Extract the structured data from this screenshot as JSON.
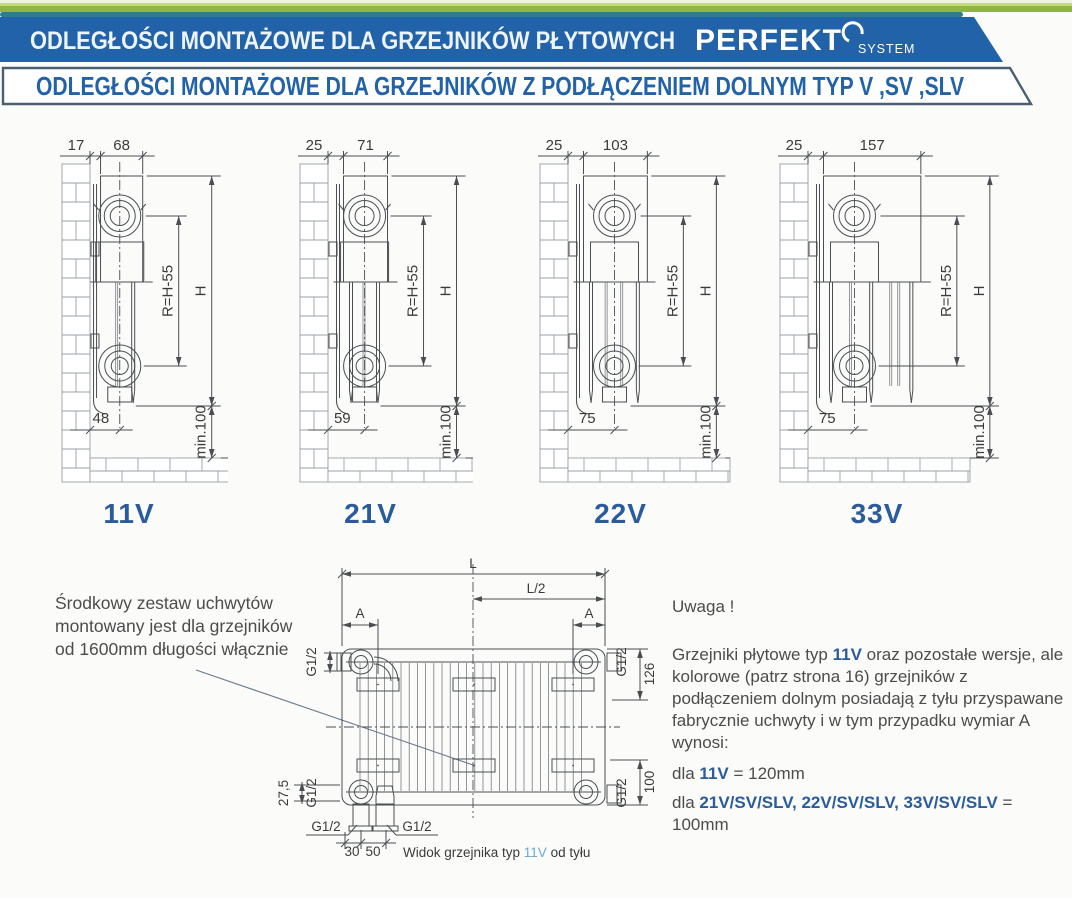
{
  "header": {
    "row1": "ODLEGŁOŚCI  MONTAŻOWE  DLA  GRZEJNIKÓW  PŁYTOWYCH",
    "brand": "PERFEKT",
    "brand_sub": "SYSTEM",
    "row2": "ODLEGŁOŚCI MONTAŻOWE DLA GRZEJNIKÓW Z PODŁĄCZENIEM DOLNYM TYP V ,SV ,SLV"
  },
  "colors": {
    "banner_blue": "#2262a8",
    "banner_green": "#8fb640",
    "banner_green_light": "#c3d784",
    "banner_pale": "#eef3dc",
    "banner_teal": "#2c7e8f",
    "row2_border": "#4a6070",
    "accent_blue": "#2a5c9c",
    "caption_type_blue": "#6ca9cd",
    "text_gray": "#4c4c4c",
    "line_gray": "#4a4e52"
  },
  "diagrams": [
    {
      "label": "11V",
      "gap": "17",
      "depth": "68",
      "bottom": "48",
      "r": "R=H-55",
      "h": "H",
      "min": "min.100",
      "gap_mm": 17,
      "depth_mm": 68,
      "bottom_mm": 48,
      "panels": 1,
      "fins": 1
    },
    {
      "label": "21V",
      "gap": "25",
      "depth": "71",
      "bottom": "59",
      "r": "R=H-55",
      "h": "H",
      "min": "min.100",
      "gap_mm": 25,
      "depth_mm": 71,
      "bottom_mm": 59,
      "panels": 2,
      "fins": 1
    },
    {
      "label": "22V",
      "gap": "25",
      "depth": "103",
      "bottom": "75",
      "r": "R=H-55",
      "h": "H",
      "min": "min.100",
      "gap_mm": 25,
      "depth_mm": 103,
      "bottom_mm": 75,
      "panels": 2,
      "fins": 2
    },
    {
      "label": "33V",
      "gap": "25",
      "depth": "157",
      "bottom": "75",
      "r": "R=H-55",
      "h": "H",
      "min": "min.100",
      "gap_mm": 25,
      "depth_mm": 157,
      "bottom_mm": 75,
      "panels": 3,
      "fins": 3
    }
  ],
  "note_left": {
    "text": "Środkowy zestaw uchwytów montowany jest dla grzejników od 1600mm długości włącznie"
  },
  "rear": {
    "L": "L",
    "L_half": "L/2",
    "A": "A",
    "G12": "G1/2",
    "dim126": "126",
    "dim100": "100",
    "dim275": "27,5",
    "dim30": "30",
    "dim50": "50",
    "caption_before": "Widok grzejnika typ ",
    "caption_type": "11V",
    "caption_after": " od tyłu"
  },
  "note_right": {
    "title": "Uwaga !",
    "p_before": "Grzejniki płytowe typ ",
    "p_bold": "11V",
    "p_after": " oraz pozostałe wersje, ale kolorowe (patrz strona 16) grzejników z podłączeniem dolnym posiadają z tyłu przyspawane fabrycznie uchwyty i w tym przypadku wymiar A wynosi:",
    "line1_before": "dla ",
    "line1_bold": "11V",
    "line1_after": " = 120mm",
    "line2_before": "dla ",
    "line2_bold": "21V/SV/SLV, 22V/SV/SLV, 33V/SV/SLV",
    "line2_after": " = 100mm"
  }
}
